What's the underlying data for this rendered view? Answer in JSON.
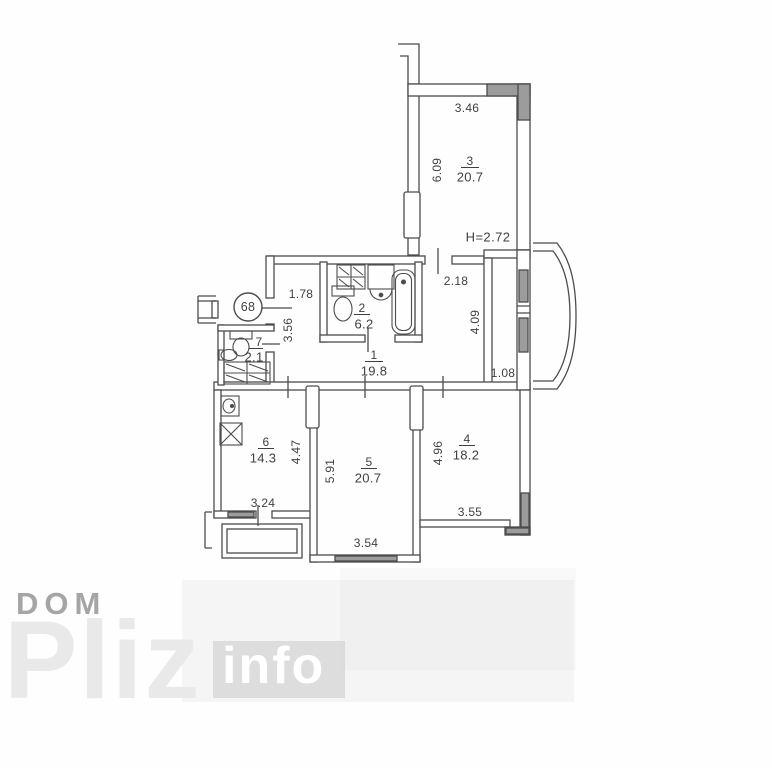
{
  "plan": {
    "unit_number": "68",
    "ceiling_height": "H=2.72",
    "rooms": {
      "r1": {
        "number": "1",
        "area": "19.8"
      },
      "r2": {
        "number": "2",
        "area": "6.2"
      },
      "r3": {
        "number": "3",
        "area": "20.7"
      },
      "r4": {
        "number": "4",
        "area": "18.2"
      },
      "r5": {
        "number": "5",
        "area": "20.7"
      },
      "r6": {
        "number": "6",
        "area": "14.3"
      },
      "r7": {
        "number": "7",
        "area": "2.1"
      }
    },
    "dims": {
      "room3_width": "3.46",
      "room3_depth": "6.09",
      "corridor": "2.18",
      "hall_top": "1.78",
      "hall_left": "3.56",
      "niche_depth": "4.09",
      "niche_width": "1.08",
      "kitchen_depth": "4.47",
      "kitchen_width": "3.24",
      "room5_depth": "5.91",
      "room5_width": "3.54",
      "room4_depth": "4.96",
      "room4_width": "3.55"
    }
  },
  "watermark": {
    "dom": "DOM",
    "pliz": "Pliz",
    "info": "info"
  },
  "colors": {
    "line": "#4c4c4c",
    "window_gray": "#9c9c9c",
    "text": "#3a3a3a"
  }
}
